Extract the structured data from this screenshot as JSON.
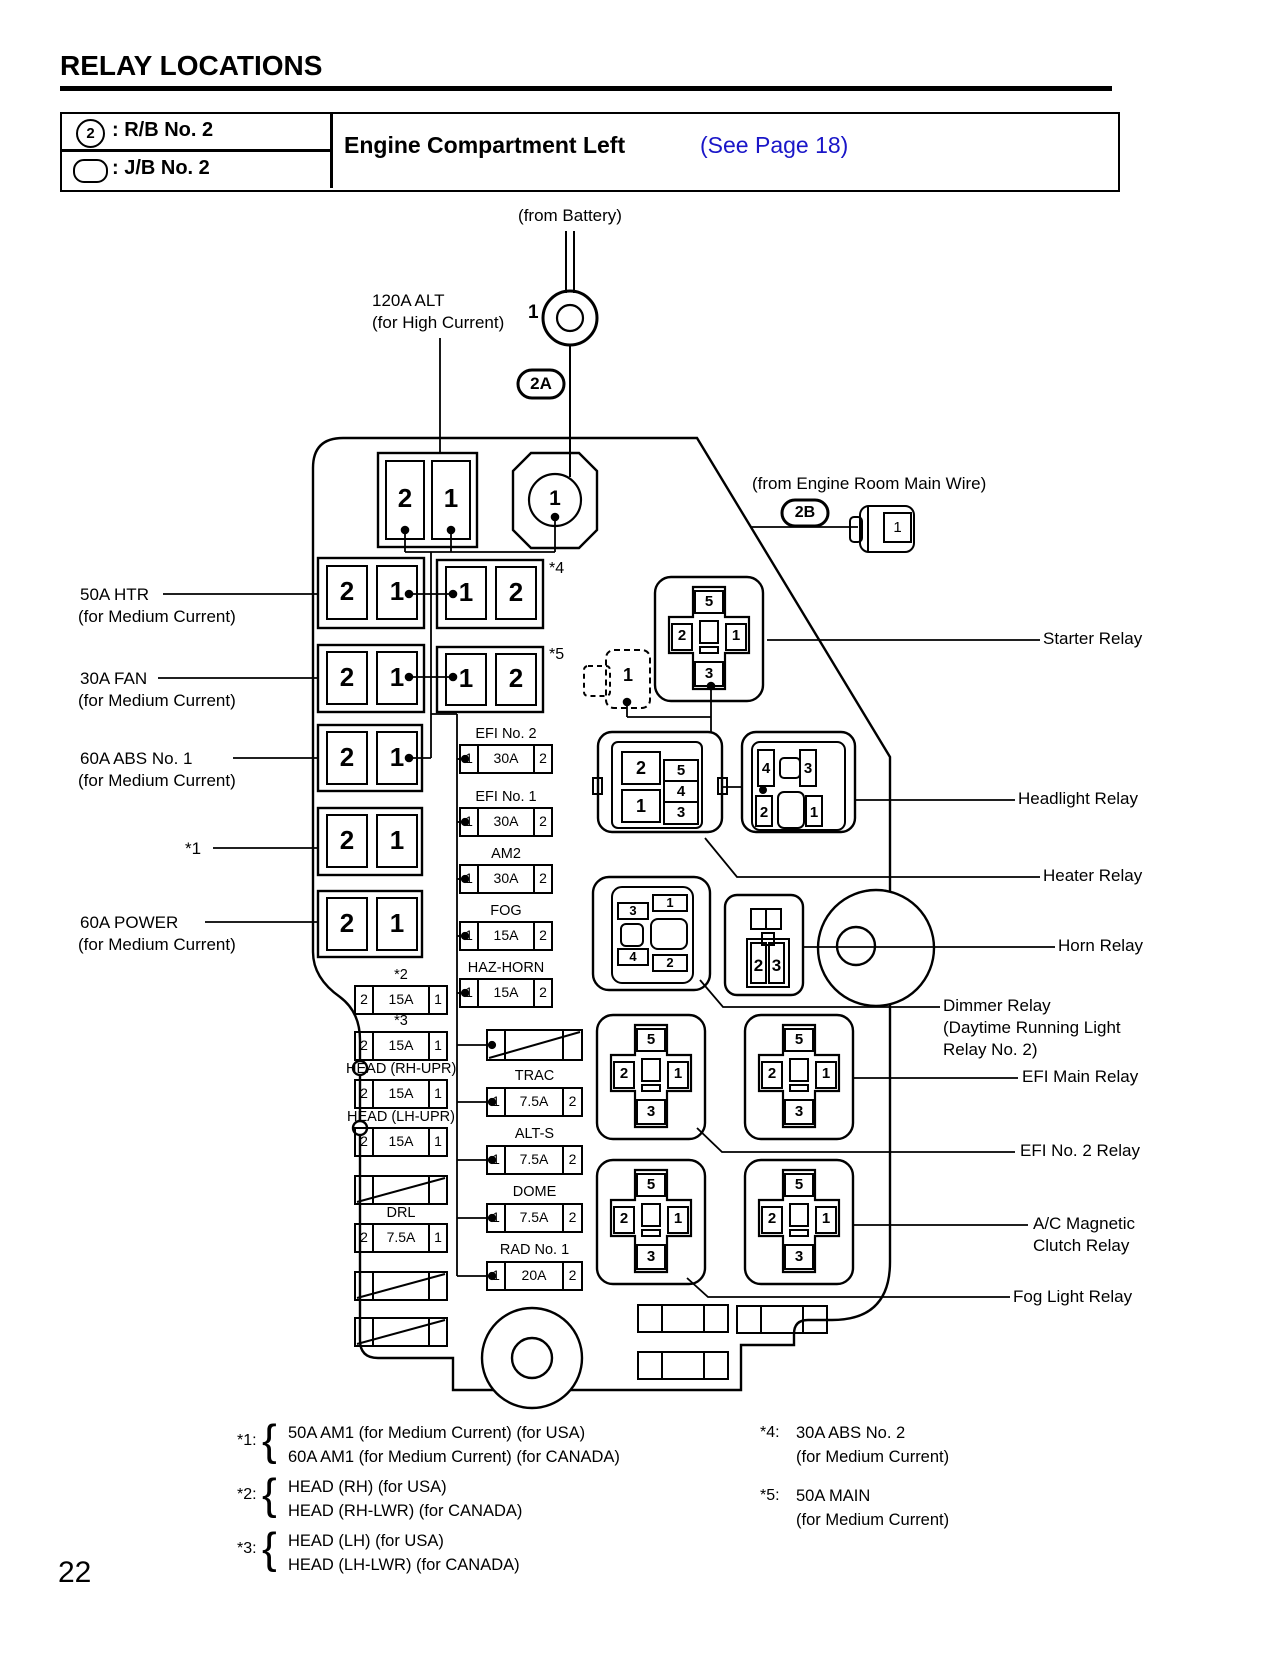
{
  "header": {
    "page_title": "RELAY LOCATIONS",
    "legend": [
      {
        "symbol": "2",
        "label": ": R/B No. 2"
      },
      {
        "symbol": "",
        "label": ": J/B No. 2"
      }
    ],
    "section_title": "Engine Compartment Left",
    "section_link": "(See Page 18)"
  },
  "colors": {
    "link_blue": "#1a16c8",
    "ink": "#000000"
  },
  "top": {
    "from_battery": "(from Battery)",
    "battery_pin": "1",
    "alt_line1": "120A ALT",
    "alt_line2": "(for High Current)",
    "badge_2a": "2A",
    "badge_2b": "2B",
    "engine_room_wire": "(from Engine Room Main Wire)",
    "engine_room_pin": "1",
    "octagon_pin": "1"
  },
  "pair_fuses": {
    "top": [
      "2",
      "1"
    ],
    "r1_left": [
      "2",
      "1"
    ],
    "r1_right": [
      "1",
      "2"
    ],
    "r1_note": "*4",
    "r2_left": [
      "2",
      "1"
    ],
    "r2_right": [
      "1",
      "2"
    ],
    "r2_note": "*5",
    "r3": [
      "2",
      "1"
    ],
    "r4": [
      "2",
      "1"
    ],
    "r5": [
      "2",
      "1"
    ],
    "dashed_pin": "1"
  },
  "left_labels": [
    {
      "l1": "50A HTR",
      "l2": "(for Medium Current)"
    },
    {
      "l1": "30A FAN",
      "l2": "(for Medium Current)"
    },
    {
      "l1": "60A ABS No. 1",
      "l2": "(for Medium Current)"
    },
    {
      "l1": "*1",
      "l2": ""
    },
    {
      "l1": "60A POWER",
      "l2": "(for Medium Current)"
    }
  ],
  "left_fuses": [
    {
      "label": "*2",
      "cells": [
        "2",
        "15A",
        "1"
      ]
    },
    {
      "label": "*3",
      "cells": [
        "2",
        "15A",
        "1"
      ]
    },
    {
      "label": "HEAD (RH-UPR)",
      "cells": [
        "2",
        "15A",
        "1"
      ]
    },
    {
      "label": "HEAD (LH-UPR)",
      "cells": [
        "2",
        "15A",
        "1"
      ]
    },
    {
      "label": "DRL",
      "cells": [
        "2",
        "7.5A",
        "1"
      ]
    }
  ],
  "mid_fuses": [
    {
      "label": "EFI No. 2",
      "cells": [
        "1",
        "30A",
        "2"
      ]
    },
    {
      "label": "EFI No. 1",
      "cells": [
        "1",
        "30A",
        "2"
      ]
    },
    {
      "label": "AM2",
      "cells": [
        "1",
        "30A",
        "2"
      ]
    },
    {
      "label": "FOG",
      "cells": [
        "1",
        "15A",
        "2"
      ]
    },
    {
      "label": "HAZ-HORN",
      "cells": [
        "1",
        "15A",
        "2"
      ]
    },
    {
      "label": "TRAC",
      "cells": [
        "1",
        "7.5A",
        "2"
      ]
    },
    {
      "label": "ALT-S",
      "cells": [
        "1",
        "7.5A",
        "2"
      ]
    },
    {
      "label": "DOME",
      "cells": [
        "1",
        "7.5A",
        "2"
      ]
    },
    {
      "label": "RAD No. 1",
      "cells": [
        "1",
        "20A",
        "2"
      ]
    }
  ],
  "cross_pins": [
    "5",
    "2",
    "1",
    "3"
  ],
  "heater_pins": {
    "left": [
      "2",
      "1"
    ],
    "right": [
      "5",
      "4",
      "3"
    ]
  },
  "headlight_pins": {
    "top": [
      "4",
      "3"
    ],
    "bottom": [
      "2",
      "1"
    ]
  },
  "dimmer_pins": {
    "tl": "3",
    "tr": "1",
    "bl": "4",
    "br": "2"
  },
  "horn_pins": [
    "2",
    "3"
  ],
  "relay_labels": {
    "starter": "Starter Relay",
    "headlight": "Headlight Relay",
    "heater": "Heater Relay",
    "horn": "Horn Relay",
    "dimmer1": "Dimmer Relay",
    "dimmer2": "(Daytime Running Light",
    "dimmer3": "Relay No. 2)",
    "efi_main": "EFI Main Relay",
    "efi_no2": "EFI No. 2 Relay",
    "ac1": "A/C Magnetic",
    "ac2": "Clutch Relay",
    "fog": "Fog Light Relay"
  },
  "punct": {
    "brace": "{"
  },
  "footnotes_left": [
    {
      "star": "*1:",
      "lines": [
        "50A AM1 (for Medium Current) (for USA)",
        "60A AM1 (for Medium Current) (for CANADA)"
      ]
    },
    {
      "star": "*2:",
      "lines": [
        "HEAD (RH) (for USA)",
        "HEAD (RH-LWR) (for CANADA)"
      ]
    },
    {
      "star": "*3:",
      "lines": [
        "HEAD (LH) (for USA)",
        "HEAD (LH-LWR) (for CANADA)"
      ]
    }
  ],
  "footnotes_right": [
    {
      "star": "*4:",
      "lines": [
        "30A ABS No. 2",
        "(for Medium Current)"
      ]
    },
    {
      "star": "*5:",
      "lines": [
        "50A MAIN",
        "(for Medium Current)"
      ]
    }
  ],
  "page_number": "22"
}
